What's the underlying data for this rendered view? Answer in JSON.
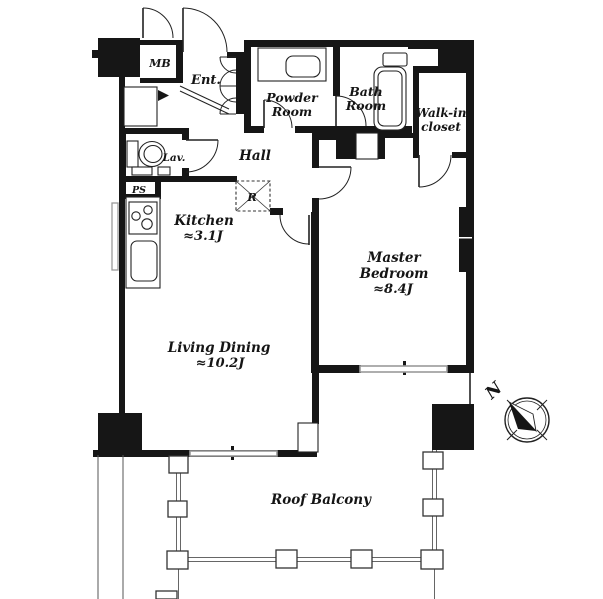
{
  "plan": {
    "kind": "apartment floor plan",
    "rooms": {
      "mb": "MB",
      "entrance": "Ent.",
      "powder_line1": "Powder",
      "powder_line2": "Room",
      "bath_line1": "Bath",
      "bath_line2": "Room",
      "closet_line1": "Walk-in",
      "closet_line2": "closet",
      "lavatory": "Lav.",
      "pipe_space": "PS",
      "hall": "Hall",
      "refrigerator": "R",
      "kitchen_name": "Kitchen",
      "kitchen_size": "≈3.1J",
      "master_line1": "Master",
      "master_line2": "Bedroom",
      "master_size": "≈8.4J",
      "living_name": "Living Dining",
      "living_size": "≈10.2J",
      "balcony": "Roof Balcony"
    },
    "compass": {
      "north_label": "N"
    },
    "colors": {
      "wall": "#161616",
      "window_line": "#9a9a9a",
      "background": "#ffffff"
    }
  }
}
